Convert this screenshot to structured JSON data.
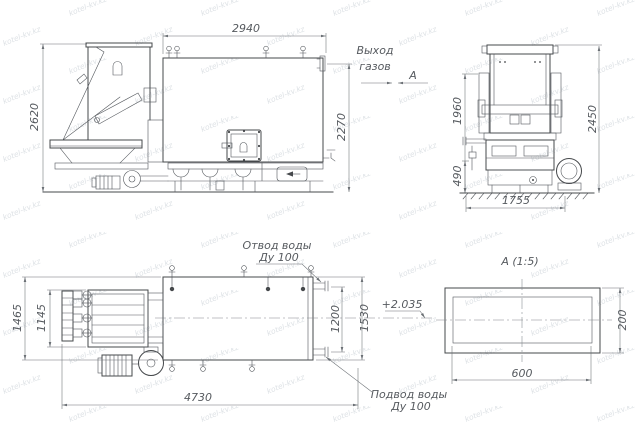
{
  "watermark": {
    "text": "kotel-kv.kz"
  },
  "annotations": {
    "gas_outlet_line1": "Выход",
    "gas_outlet_line2": "газов",
    "section_marker": "А"
  },
  "side_view": {
    "dim_width_top": "2940",
    "dim_height_left": "2620",
    "dim_height_right": "2270"
  },
  "front_view": {
    "dim_height_left": "1960",
    "dim_height_right": "2450",
    "dim_base_height": "490",
    "dim_width_bottom": "1755"
  },
  "plan_view": {
    "dim_width_outer": "1465",
    "dim_width_inner": "1145",
    "dim_length_bottom": "4730",
    "dim_pipe_span": "1200",
    "dim_width_right": "1530",
    "level_mark": "+2.035",
    "outlet_label_line1": "Отвод воды",
    "outlet_label_line2": "Ду 100",
    "inlet_label_line1": "Подвод воды",
    "inlet_label_line2": "Ду 100"
  },
  "section_view": {
    "title": "А  (1:5)",
    "dim_width": "600",
    "dim_height": "200"
  }
}
